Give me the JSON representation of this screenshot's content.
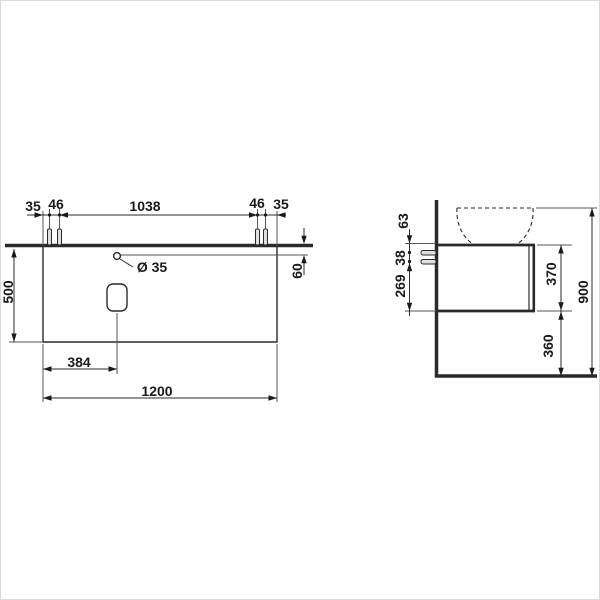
{
  "front_view": {
    "top_dims": [
      "35",
      "46",
      "1038",
      "46",
      "35"
    ],
    "depth": "500",
    "hole_diameter": "Ø 35",
    "hole_offset": "60",
    "cutout_offset": "384",
    "total_width": "1200"
  },
  "side_view": {
    "upper_offset": "63",
    "bracket_spacing": "38",
    "lower_offset": "269",
    "cabinet_height": "370",
    "floor_clearance": "360",
    "total_height": "900"
  },
  "colors": {
    "line": "#2a2a2a",
    "thin_line": "#555555",
    "background": "#ffffff",
    "fixture_fill": "#e0e0e0"
  }
}
